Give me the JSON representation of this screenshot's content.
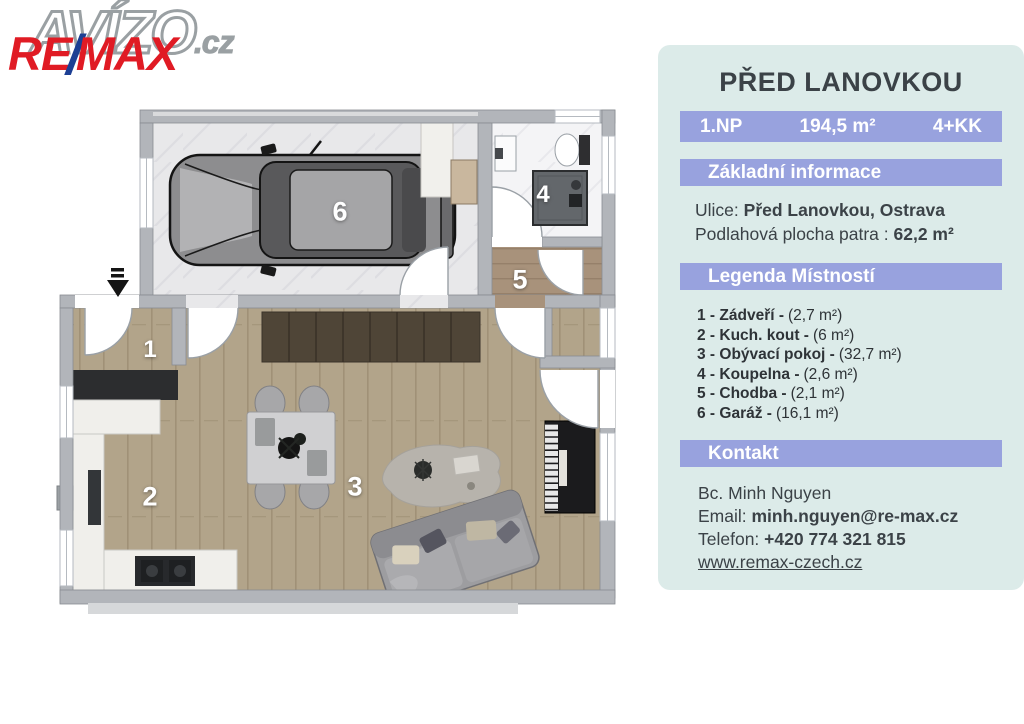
{
  "logos": {
    "avizo_main": "AVÍZO",
    "avizo_suffix": ".cz",
    "remax_re": "RE",
    "remax_slash": "/",
    "remax_max": "MAX"
  },
  "panel": {
    "title": "PŘED LANOVKOU",
    "stats": {
      "floor": "1.NP",
      "area": "194,5 m²",
      "layout": "4+KK"
    },
    "sections": {
      "basic_info": "Základní informace",
      "legend": "Legenda Místností",
      "contact": "Kontakt"
    },
    "basic_info": {
      "street_label": "Ulice:",
      "street_value": "Před Lanovkou, Ostrava",
      "floor_area_label": "Podlahová plocha patra :",
      "floor_area_value": "62,2 m²"
    },
    "legend_items": [
      {
        "label": "1 - Zádveří -",
        "area": "(2,7 m²)"
      },
      {
        "label": "2 - Kuch. kout -",
        "area": "(6 m²)"
      },
      {
        "label": "3 - Obývací pokoj -",
        "area": "(32,7 m²)"
      },
      {
        "label": "4 - Koupelna -",
        "area": "(2,6 m²)"
      },
      {
        "label": "5 - Chodba -",
        "area": "(2,1 m²)"
      },
      {
        "label": "6 - Garáž -",
        "area": "(16,1 m²)"
      }
    ],
    "contact": {
      "name": "Bc. Minh Nguyen",
      "email_label": "Email:",
      "email_value": "minh.nguyen@re-max.cz",
      "phone_label": "Telefon:",
      "phone_value": "+420 774 321 815",
      "website": "www.remax-czech.cz"
    }
  },
  "floorplan": {
    "room_labels": {
      "entry": "1",
      "kitchen": "2",
      "living": "3",
      "bath": "4",
      "hall": "5",
      "garage": "6"
    }
  },
  "colors": {
    "panel_bg": "#dcebe9",
    "banner": "#98a2de",
    "text_dark": "#3b4247",
    "remax_red": "#e01b24",
    "remax_blue": "#1c3f94",
    "wall_gray": "#b2b5ba",
    "wood_floor": "#b2a48a",
    "hall_wood": "#a8927b",
    "marble_floor": "#e8e8ea"
  }
}
